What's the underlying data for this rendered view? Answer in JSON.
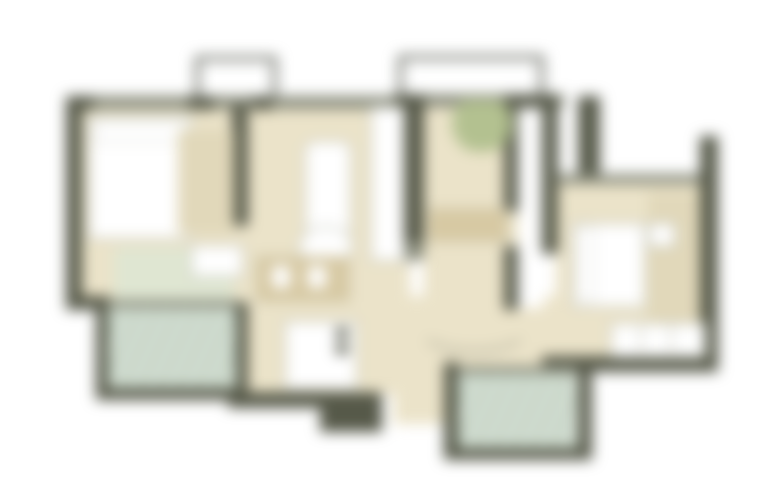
{
  "image": {
    "kind": "architectural-floor-plan",
    "appearance": "heavily-blurred",
    "background": "#ffffff"
  },
  "palette": {
    "wall": "#565949",
    "wall-medium": "#8a8d7d",
    "outline": "#70736a",
    "floor": "#ebe3c9",
    "floor-shade": "#e1d8ba",
    "tile": "#d3ded2",
    "tile-shade": "#b9cabb",
    "rug-green": "#dfe6d2",
    "furniture-tan": "#d7c9a3",
    "furn-border": "#bdbfb2",
    "plant-green": "#b3c190",
    "white": "#ffffff"
  },
  "rooms": [
    {
      "name": "bedroom-left"
    },
    {
      "name": "living-dining"
    },
    {
      "name": "entry-hall"
    },
    {
      "name": "bedroom-right"
    },
    {
      "name": "bathroom"
    },
    {
      "name": "balcony-bottom-left"
    },
    {
      "name": "balcony-bottom-center"
    },
    {
      "name": "balcony-top-left"
    },
    {
      "name": "balcony-top-middle"
    }
  ],
  "furniture": [
    {
      "name": "double-bed-left"
    },
    {
      "name": "double-bed-right"
    },
    {
      "name": "wardrobe-right"
    },
    {
      "name": "sofa"
    },
    {
      "name": "coffee-table"
    },
    {
      "name": "dining-table"
    },
    {
      "name": "kitchen-fixture"
    },
    {
      "name": "entry-console"
    },
    {
      "name": "plant"
    },
    {
      "name": "area-rug"
    }
  ]
}
